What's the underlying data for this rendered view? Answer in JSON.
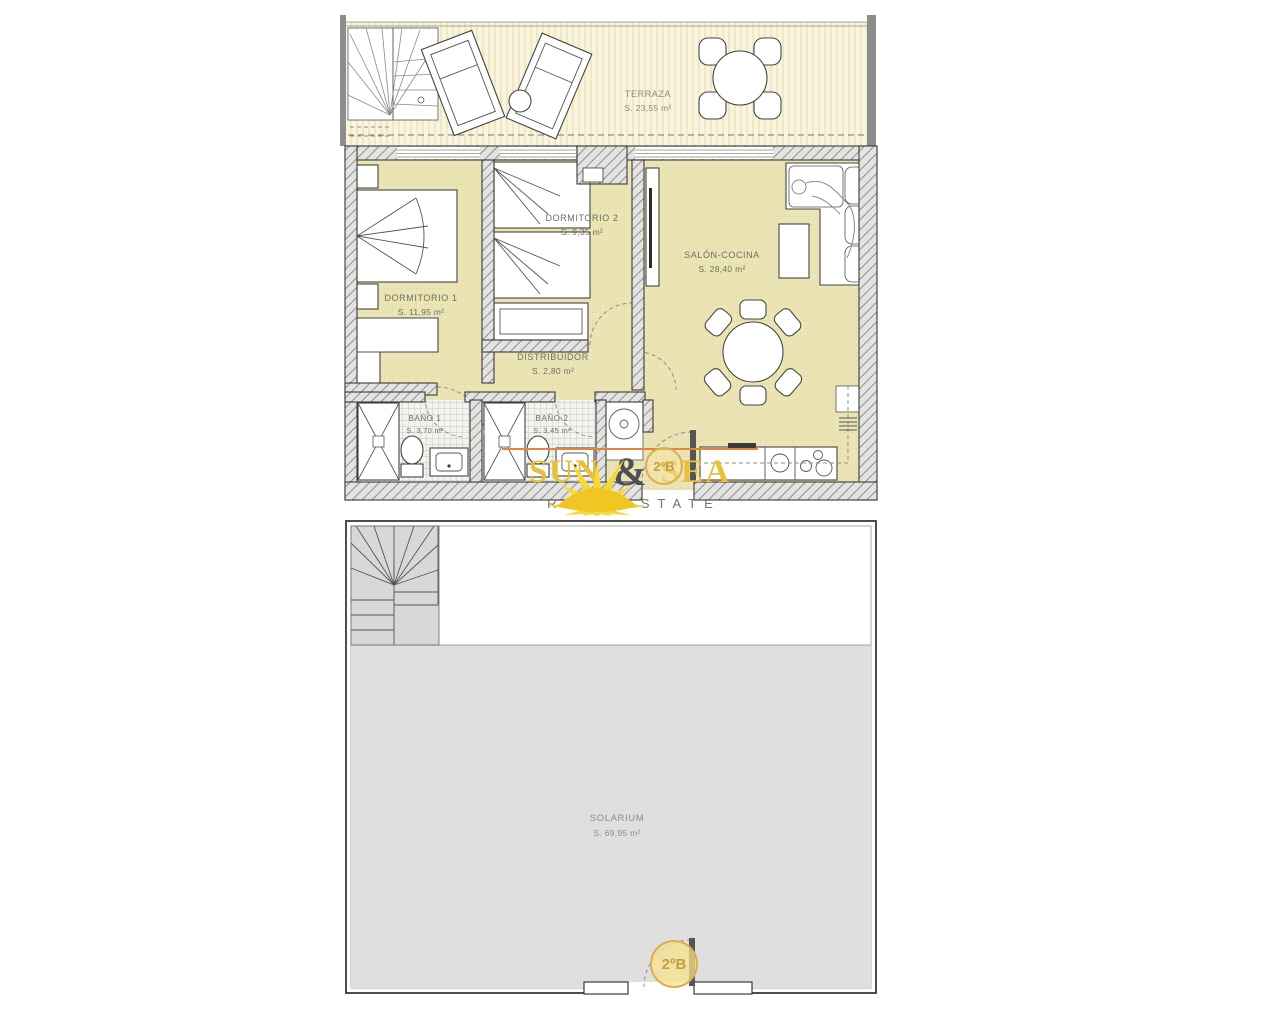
{
  "unit": {
    "badge": "2ºB"
  },
  "logo": {
    "word1": "SUN",
    "amp": "&",
    "word2": "SEA",
    "tagline": "REAL ESTATE"
  },
  "rooms": {
    "terraza": {
      "name": "TERRAZA",
      "area": "S. 23,55 m²"
    },
    "dormitorio1": {
      "name": "DORMITORIO 1",
      "area": "S. 11,95 m²"
    },
    "dormitorio2": {
      "name": "DORMITORIO 2",
      "area": "S. 9,35 m²"
    },
    "salon": {
      "name": "SALÓN-COCINA",
      "area": "S. 28,40 m²"
    },
    "distribuidor": {
      "name": "DISTRIBUIDOR",
      "area": "S. 2,80 m²"
    },
    "bano1": {
      "name": "BAÑO 1",
      "area": "S. 3,70 m²"
    },
    "bano2": {
      "name": "BAÑO 2",
      "area": "S. 3,45 m²"
    },
    "solarium": {
      "name": "SOLARIUM",
      "area": "S. 69,95 m²"
    }
  },
  "colors": {
    "room_fill": "#ebe4b5",
    "terrace_fill": "#f8f4de",
    "solarium_fill": "#dfdfdf",
    "wall_hatch": "#8f8f8f",
    "logo_gold": "#e7c13a",
    "badge_gold": "#dcae52"
  }
}
